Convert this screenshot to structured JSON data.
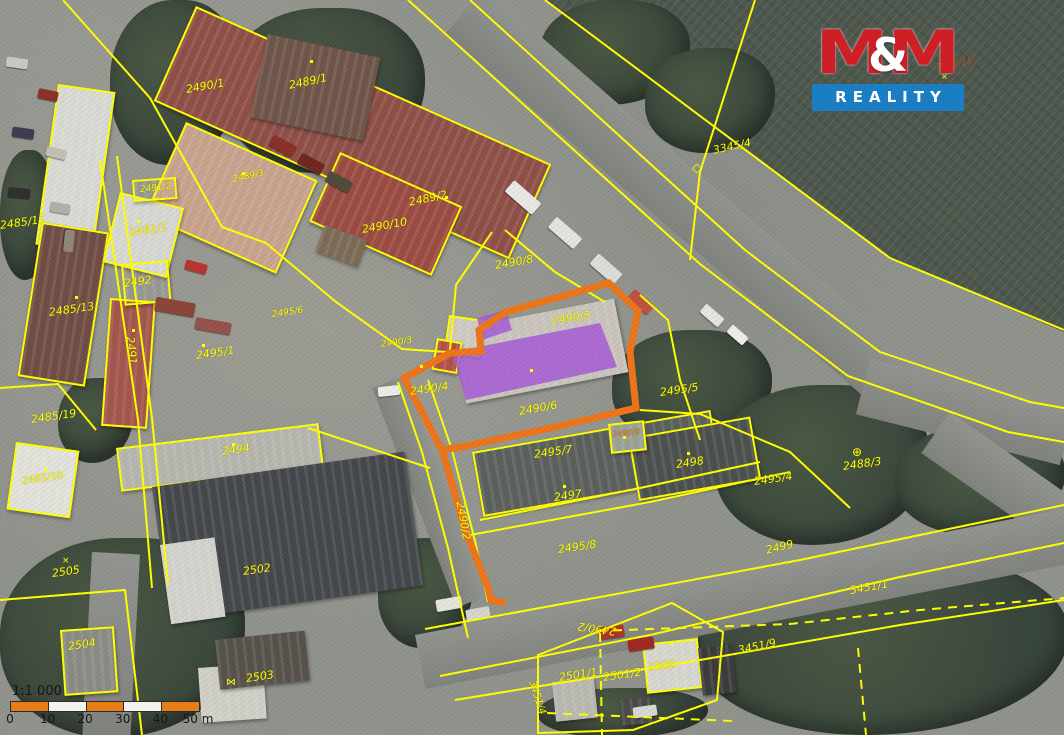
{
  "map": {
    "colors": {
      "parcel_line": "#ffff00",
      "highlight_boundary": "#ed7418",
      "highlight_building": "#a557d6",
      "logo_red": "#cf1f26",
      "logo_blue": "#1b7ec2"
    },
    "parcel_labels": [
      {
        "text": "2490/1",
        "x": 186,
        "y": 84,
        "rot": -10
      },
      {
        "text": "2489/1",
        "x": 289,
        "y": 80,
        "rot": -12
      },
      {
        "text": "2489/3",
        "x": 233,
        "y": 176,
        "rot": -12,
        "size": 9
      },
      {
        "text": "2489/2",
        "x": 409,
        "y": 197,
        "rot": -12
      },
      {
        "text": "2490/10",
        "x": 362,
        "y": 224,
        "rot": -10
      },
      {
        "text": "2490/8",
        "x": 495,
        "y": 260,
        "rot": -10
      },
      {
        "text": "2490/5",
        "x": 552,
        "y": 315,
        "rot": -8
      },
      {
        "text": "2490/3",
        "x": 381,
        "y": 341,
        "rot": -8,
        "size": 9
      },
      {
        "text": "2490/4",
        "x": 410,
        "y": 386,
        "rot": -8
      },
      {
        "text": "2490/6",
        "x": 519,
        "y": 406,
        "rot": -10
      },
      {
        "text": "2490/9",
        "x": 612,
        "y": 431,
        "rot": -6,
        "size": 8,
        "color": "#d98a2b"
      },
      {
        "text": "2495/5",
        "x": 660,
        "y": 387,
        "rot": -8
      },
      {
        "text": "2495/7",
        "x": 534,
        "y": 449,
        "rot": -8
      },
      {
        "text": "2497",
        "x": 554,
        "y": 492,
        "rot": -8
      },
      {
        "text": "2498",
        "x": 676,
        "y": 459,
        "rot": -8
      },
      {
        "text": "2495/4",
        "x": 754,
        "y": 476,
        "rot": -8
      },
      {
        "text": "2488/3",
        "x": 843,
        "y": 461,
        "rot": -8
      },
      {
        "text": "2495/8",
        "x": 558,
        "y": 544,
        "rot": -8
      },
      {
        "text": "2499",
        "x": 766,
        "y": 545,
        "rot": -14
      },
      {
        "text": "2490/2",
        "x": 460,
        "y": 496,
        "rot": 80
      },
      {
        "text": "2490/2",
        "x": 616,
        "y": 626,
        "rot": 188
      },
      {
        "text": "2505",
        "x": 52,
        "y": 568,
        "rot": -8
      },
      {
        "text": "2502",
        "x": 243,
        "y": 566,
        "rot": -8
      },
      {
        "text": "2504",
        "x": 68,
        "y": 641,
        "rot": -8
      },
      {
        "text": "2503",
        "x": 246,
        "y": 673,
        "rot": -8
      },
      {
        "text": "2485/15",
        "x": 0,
        "y": 220,
        "rot": -8
      },
      {
        "text": "2491/2",
        "x": 140,
        "y": 186,
        "rot": -6,
        "size": 9
      },
      {
        "text": "2491/1",
        "x": 129,
        "y": 227,
        "rot": -8
      },
      {
        "text": "2492",
        "x": 124,
        "y": 278,
        "rot": -8
      },
      {
        "text": "2491",
        "x": 130,
        "y": 331,
        "rot": 84
      },
      {
        "text": "2485/13",
        "x": 49,
        "y": 307,
        "rot": -8
      },
      {
        "text": "2495/1",
        "x": 196,
        "y": 350,
        "rot": -8
      },
      {
        "text": "2485/19",
        "x": 31,
        "y": 414,
        "rot": -8
      },
      {
        "text": "2494",
        "x": 222,
        "y": 446,
        "rot": -8
      },
      {
        "text": "2485/10",
        "x": 22,
        "y": 477,
        "rot": -8,
        "size": 10
      },
      {
        "text": "2495/6",
        "x": 272,
        "y": 311,
        "rot": -8,
        "size": 9
      },
      {
        "text": "3345/4",
        "x": 713,
        "y": 145,
        "rot": -12
      },
      {
        "text": "3345/15",
        "x": 936,
        "y": 64,
        "rot": -10,
        "size": 9,
        "color": "#c8551e"
      },
      {
        "text": "3451/1",
        "x": 850,
        "y": 585,
        "rot": -10
      },
      {
        "text": "3451/9",
        "x": 738,
        "y": 645,
        "rot": -12
      },
      {
        "text": "2501/1",
        "x": 559,
        "y": 672,
        "rot": -8
      },
      {
        "text": "2501/2",
        "x": 603,
        "y": 672,
        "rot": -8
      },
      {
        "text": "2500",
        "x": 648,
        "y": 662,
        "rot": -8
      },
      {
        "text": "3451/4",
        "x": 531,
        "y": 676,
        "rot": 72,
        "size": 10
      }
    ],
    "marker_dots": [
      [
        310,
        60
      ],
      [
        445,
        196
      ],
      [
        242,
        172
      ],
      [
        137,
        220
      ],
      [
        75,
        296
      ],
      [
        232,
        443
      ],
      [
        563,
        485
      ],
      [
        687,
        452
      ],
      [
        530,
        369
      ],
      [
        420,
        365
      ],
      [
        623,
        436
      ],
      [
        670,
        642
      ],
      [
        132,
        329
      ],
      [
        44,
        468
      ],
      [
        202,
        344
      ]
    ],
    "symbols": [
      {
        "glyph": "◇",
        "x": 692,
        "y": 162,
        "size": 13
      },
      {
        "glyph": "⊕",
        "x": 852,
        "y": 446,
        "size": 12
      },
      {
        "glyph": "⋈",
        "x": 226,
        "y": 678,
        "size": 10
      },
      {
        "glyph": "×",
        "x": 62,
        "y": 557,
        "size": 9
      },
      {
        "glyph": "×",
        "x": 941,
        "y": 73,
        "size": 8
      }
    ]
  },
  "branding": {
    "m_left": "M",
    "ampersand": "&",
    "m_right": "M",
    "reality": "REALITY"
  },
  "scale_bar": {
    "ratio": "1:1 000",
    "ticks": [
      "0",
      "10",
      "20",
      "30",
      "40",
      "50 m"
    ],
    "segment_colors": [
      "#e87c17",
      "#f4f2ee",
      "#e87c17",
      "#f4f2ee",
      "#e87c17"
    ]
  }
}
